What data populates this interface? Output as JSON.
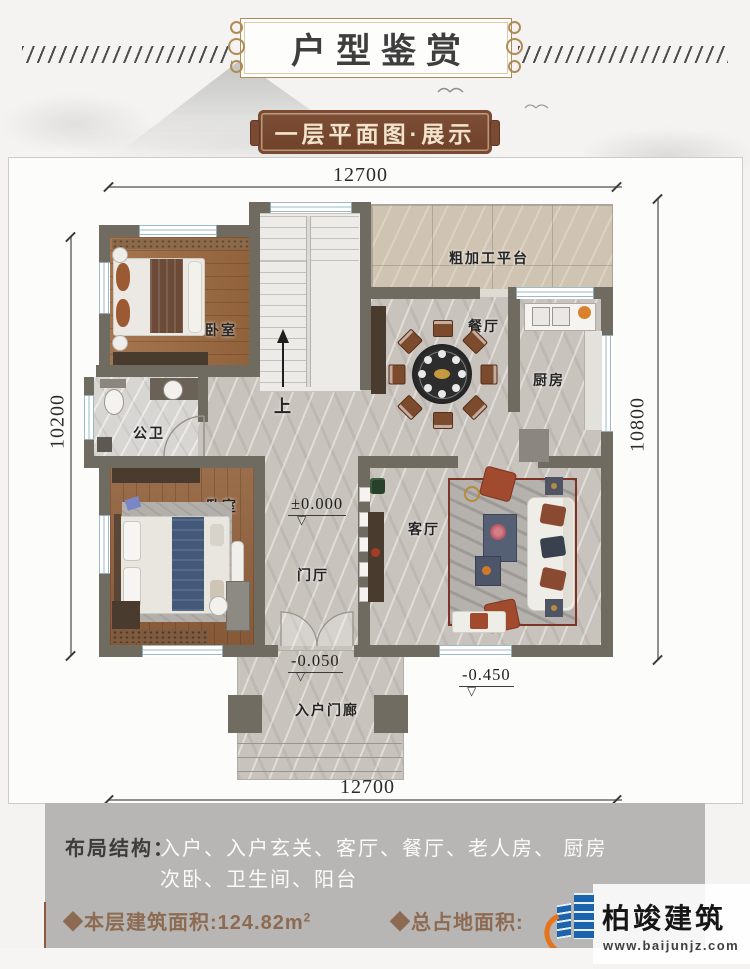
{
  "header": {
    "title": "户型鉴赏",
    "subtitle": "一层平面图·展示"
  },
  "plan": {
    "dims": {
      "top": "12700",
      "bottom": "12700",
      "left": "10200",
      "right": "10800"
    },
    "rooms": {
      "bedroom_top": "卧室",
      "bedroom_bottom": "卧室",
      "bathroom": "公卫",
      "foyer": "门厅",
      "living": "客厅",
      "dining": "餐厅",
      "kitchen": "厨房",
      "terrace": "粗加工平台",
      "porch": "入户门廊"
    },
    "stairs_up": "上",
    "levels": {
      "foyer": "±0.000",
      "porch": "-0.050",
      "living": "-0.450"
    }
  },
  "icons": {
    "level_triangle": "▽"
  },
  "footer": {
    "layout_label": "布局结构：",
    "layout_line1": "入户、入户玄关、客厅、餐厅、老人房、 厨房",
    "layout_line2": "次卧、卫生间、阳台",
    "floor_area": "◆本层建筑面积:124.82m",
    "floor_area_sup": "2",
    "total_area_label": "◆总占地面积:",
    "logo": {
      "name": "柏竣建筑",
      "url": "www.baijunjz.com"
    }
  },
  "colors": {
    "gold": "#b08c55",
    "plaque_brown": "#7a4a33",
    "area_brown": "#8d6b52",
    "wall": "#6f6b60",
    "logo_blue": "#1c63ad",
    "logo_orange": "#e4731c"
  }
}
